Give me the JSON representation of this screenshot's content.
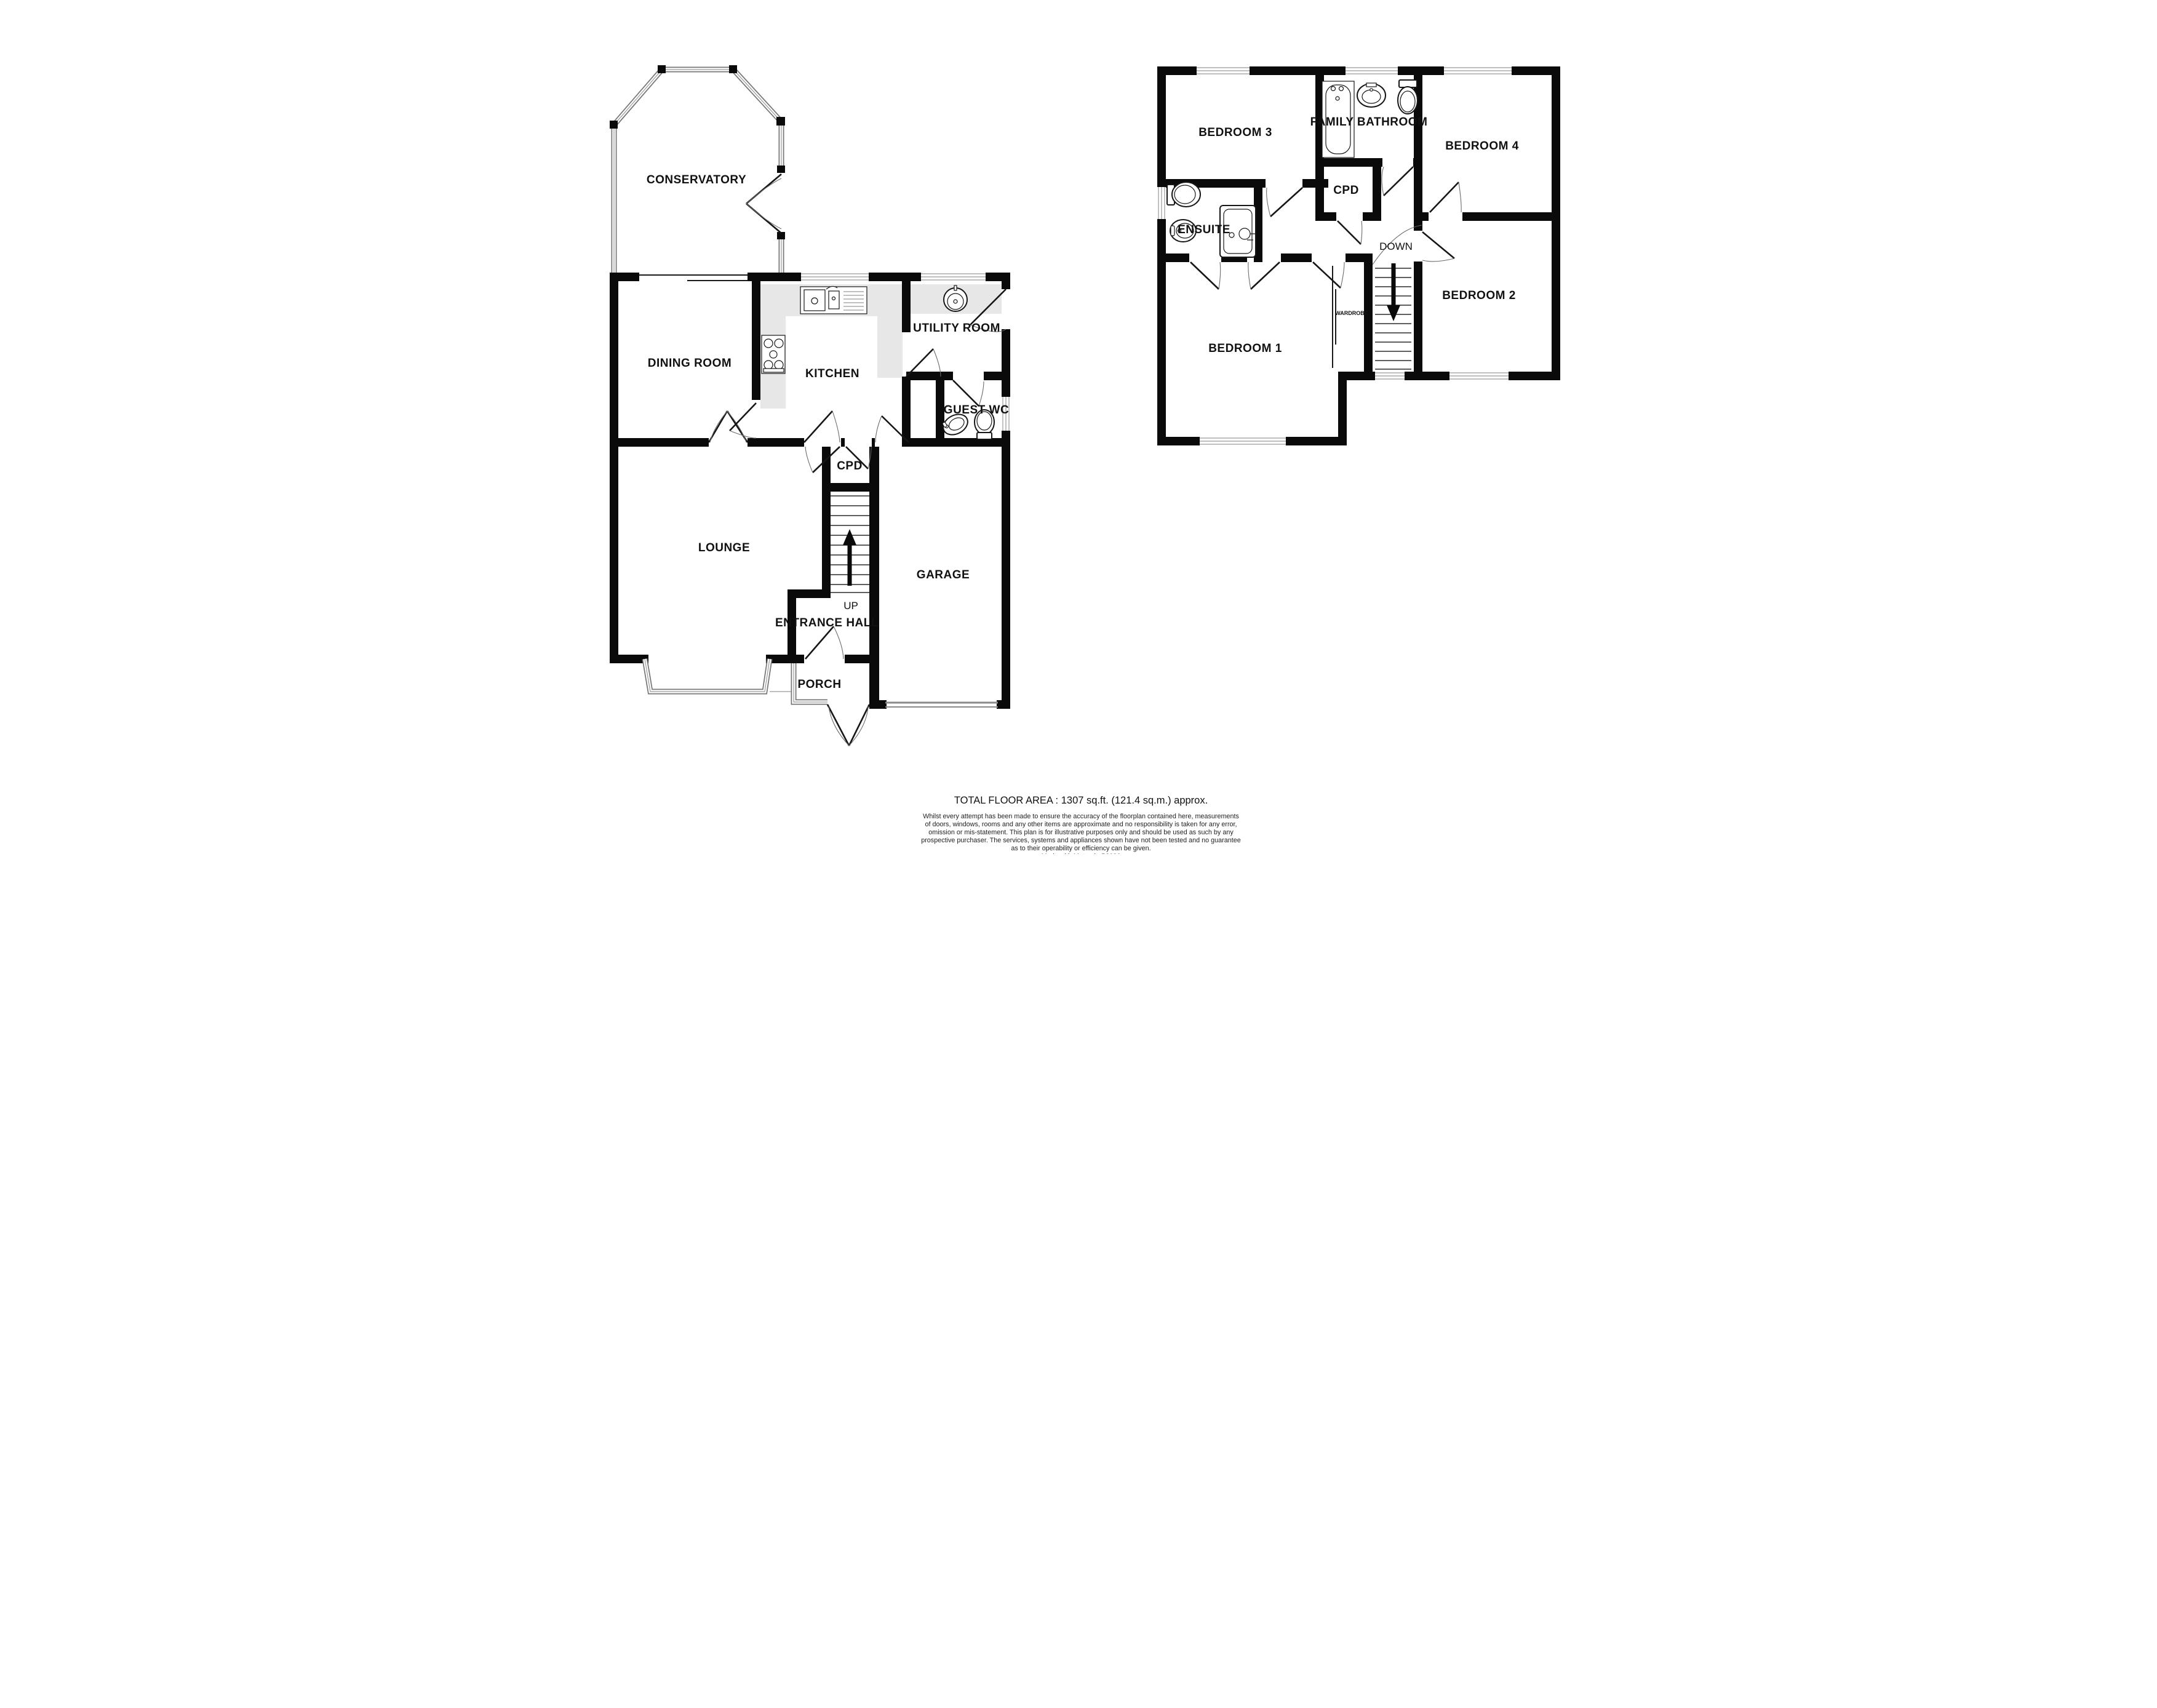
{
  "ground": {
    "rooms": {
      "conservatory": "CONSERVATORY",
      "dining_room": "DINING ROOM",
      "kitchen": "KITCHEN",
      "utility_room": "UTILITY ROOM",
      "guest_wc": "GUEST WC",
      "cpd": "CPD",
      "lounge": "LOUNGE",
      "entrance_hall": "ENTRANCE HALL",
      "porch": "PORCH",
      "garage": "GARAGE"
    },
    "stairs_direction": "UP"
  },
  "first": {
    "rooms": {
      "bedroom3": "BEDROOM 3",
      "family_bathroom": "FAMILY BATHROOM",
      "bedroom4": "BEDROOM 4",
      "cpd": "CPD",
      "ensuite": "ENSUITE",
      "bedroom2": "BEDROOM 2",
      "bedroom1": "BEDROOM 1",
      "wardrobe": "WARDROBE"
    },
    "stairs_direction": "DOWN"
  },
  "footer": {
    "total_area": "TOTAL FLOOR AREA : 1307 sq.ft. (121.4 sq.m.) approx.",
    "disclaimer_lines": [
      "Whilst every attempt has been made to ensure the accuracy of the floorplan contained here, measurements",
      "of doors, windows, rooms and any other items are approximate and no responsibility is taken for any error,",
      "omission or mis-statement. This plan is for illustrative purposes only and should be used as such by any",
      "prospective purchaser. The services, systems and appliances shown have not been tested and no guarantee",
      "as to their operability or efficiency can be given."
    ],
    "credit": "Made with Metropix ©2026"
  },
  "colors": {
    "wall": "#0a0a0a",
    "counter": "#e7e7e7",
    "window_line": "#8a8a8a",
    "garage_door": "#8a8a8a"
  }
}
